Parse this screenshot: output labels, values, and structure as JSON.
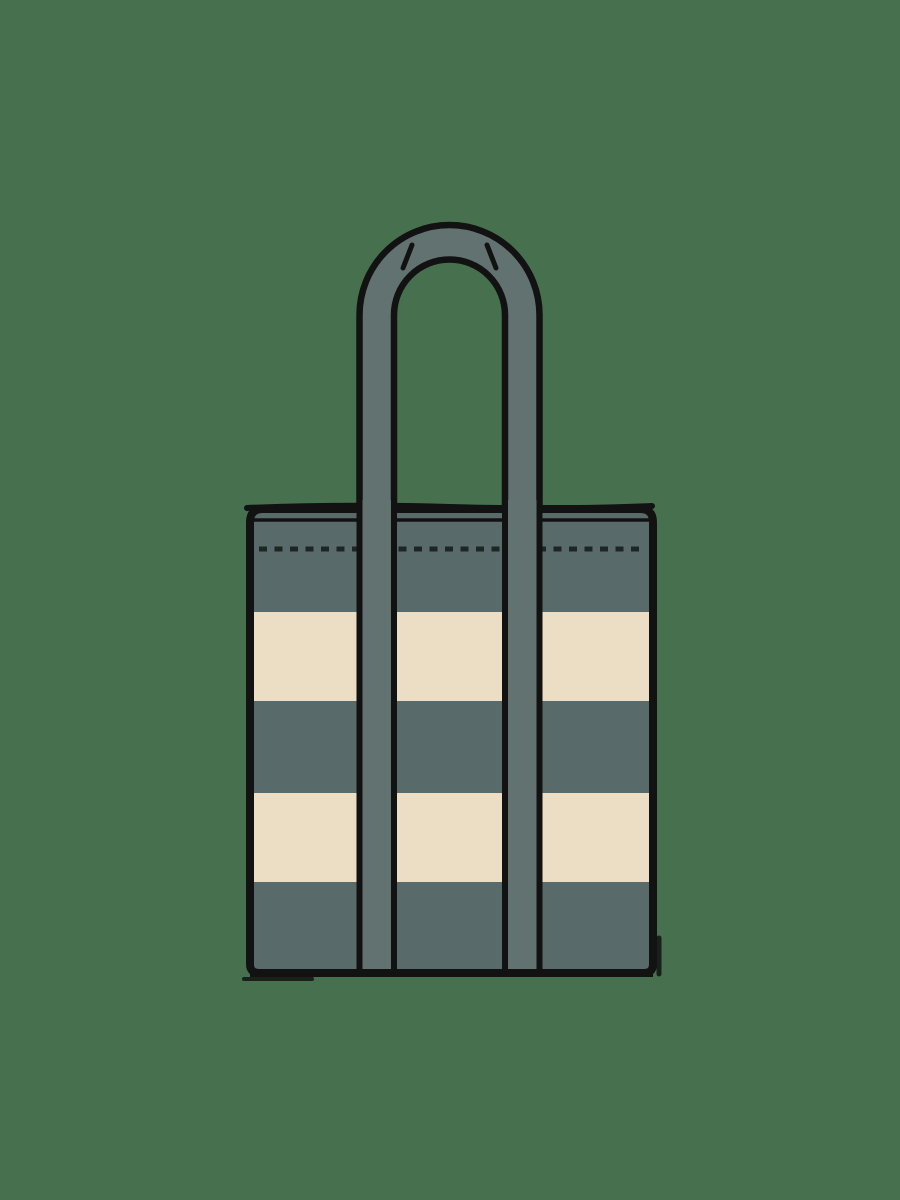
{
  "scene": {
    "type": "illustration",
    "subject": "striped tote bag",
    "description": "Flat illustration of a striped canvas tote bag with tall shoulder handles on a muted green background"
  },
  "colors": {
    "background": "#47714E",
    "bag_gray": "#596A6A",
    "stripe_cream": "#EBDEC4",
    "strap_gray": "#627271",
    "outline": "#121212",
    "stitch": "#1B2625"
  },
  "canvas": {
    "width": 900,
    "height": 1200
  },
  "bag": {
    "border": {
      "x": 250,
      "y": 509,
      "width": 403,
      "height": 464,
      "radius_top": 13,
      "radius_bottom": 9,
      "stroke_width": 8
    },
    "clip": {
      "x": 246,
      "y": 505,
      "width": 411,
      "height": 472,
      "radius_top": 16,
      "radius_bottom": 12
    },
    "rim": {
      "top_wave": "M 247 508 Q 340 504 450 507 T 652 506",
      "top_stroke_width": 6,
      "inner_line_y": 520,
      "inner_line_width": 3.5
    },
    "stitch_line": {
      "y": 549,
      "x1": 259,
      "x2": 644,
      "stroke_width": 5,
      "dash": 8,
      "gap": 7.5
    },
    "stripes": [
      {
        "color": "bag_gray",
        "y1": 509,
        "y2": 612
      },
      {
        "color": "stripe_cream",
        "y1": 612,
        "y2": 701
      },
      {
        "color": "bag_gray",
        "y1": 701,
        "y2": 793
      },
      {
        "color": "stripe_cream",
        "y1": 793,
        "y2": 882
      },
      {
        "color": "bag_gray",
        "y1": 882,
        "y2": 973
      }
    ],
    "straps": {
      "top_y": 500,
      "bottom_y": 971,
      "edge_stroke_width": 6,
      "items": [
        {
          "outer_x": 359.5,
          "inner_x": 394
        },
        {
          "outer_x": 539.5,
          "inner_x": 505
        }
      ]
    },
    "handle": {
      "center_x": 449.5,
      "outer_radius": 90,
      "inner_radius": 55.5,
      "shoulder_y": 315,
      "base_y": 516,
      "stroke_width": 6.5,
      "fold_ticks": [
        {
          "x1": 412,
          "y1": 245,
          "x2": 403,
          "y2": 268,
          "stroke_width": 5
        },
        {
          "x1": 487,
          "y1": 245,
          "x2": 496,
          "y2": 268,
          "stroke_width": 5
        }
      ]
    },
    "bottom_edge": {
      "y": 973,
      "stroke_width": 8
    },
    "ink_offsets": [
      {
        "x1": 244,
        "y1": 979,
        "x2": 312,
        "y2": 979,
        "stroke_width": 4
      },
      {
        "x1": 659,
        "y1": 938,
        "x2": 659,
        "y2": 974,
        "stroke_width": 5
      }
    ]
  }
}
